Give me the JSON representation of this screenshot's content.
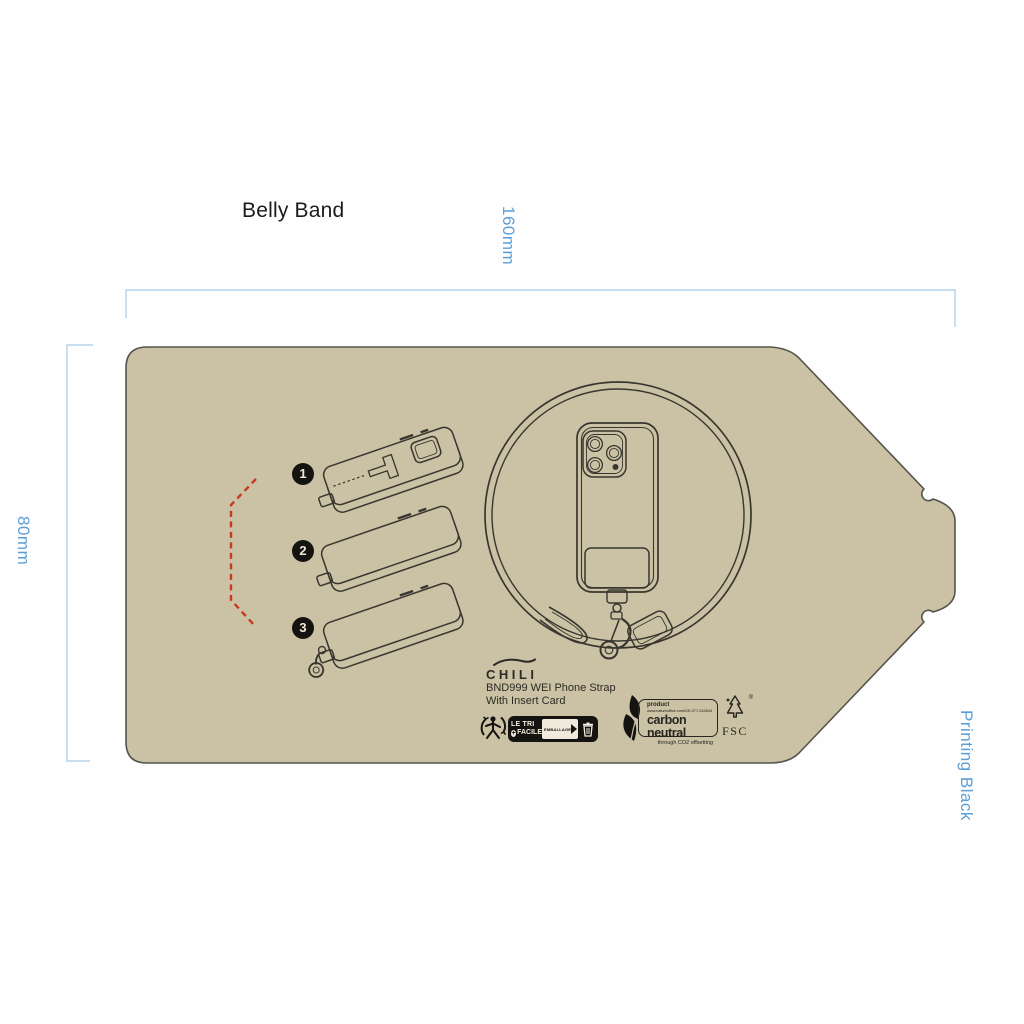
{
  "document": {
    "title": "Belly Band",
    "printing_note": "Printing Black"
  },
  "dimensions": {
    "width": "160mm",
    "height": "80mm"
  },
  "artwork": {
    "steps": [
      {
        "number": "1"
      },
      {
        "number": "2"
      },
      {
        "number": "3"
      }
    ],
    "brand": "CHILI",
    "product_name": "BND999 WEI Phone Strap",
    "product_subtitle": "With Insert Card",
    "badges": {
      "triman": {
        "line1": "LE TRI",
        "line2": "FACILE",
        "plus": "+",
        "packaging": "EMBALLAGE"
      },
      "carbon_neutral": {
        "heading": "product",
        "url": "www.natureoffice.com/DE-077-244544",
        "title": "carbon neutral",
        "subtitle": "through CO2 offsetting"
      },
      "fsc": {
        "label": "FSC",
        "registered_mark": "®"
      }
    }
  },
  "colors": {
    "band_fill": "#cbc2a5",
    "band_outline": "#55534b",
    "dimension_line": "#a6cbe8",
    "dimension_text": "#5b9ed8",
    "guide_dash_red": "#c63a1d",
    "artwork_ink": "#38362f"
  }
}
